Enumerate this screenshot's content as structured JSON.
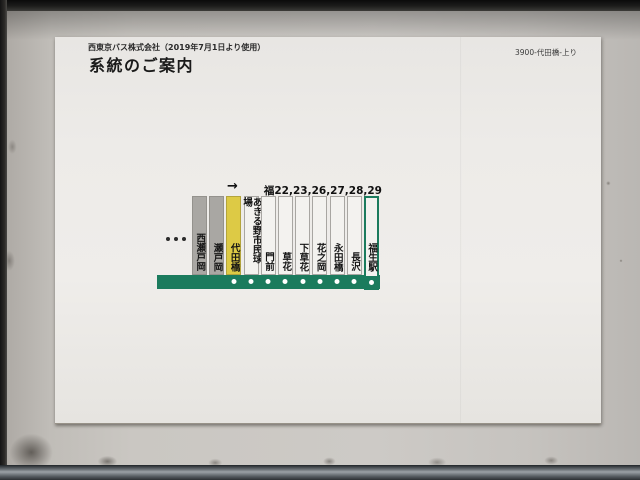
{
  "sign": {
    "company_line": "西東京バス株式会社（2019年7月1日より使用）",
    "title": "系統のご案内",
    "sign_code": "3900-代田橋-上り"
  },
  "diagram": {
    "routes_label": "福22,23,26,27,28,29",
    "direction_arrow": "→",
    "continuation_dots": "...",
    "stops": [
      {
        "name": "西瀬戸岡",
        "type": "passed"
      },
      {
        "name": "瀬戸岡",
        "type": "passed"
      },
      {
        "name": "代田橋",
        "type": "current"
      },
      {
        "name": "あきる野市民球場",
        "type": "upcoming"
      },
      {
        "name": "門前",
        "type": "upcoming"
      },
      {
        "name": "草花",
        "type": "upcoming"
      },
      {
        "name": "下草花",
        "type": "upcoming"
      },
      {
        "name": "花之岡",
        "type": "upcoming"
      },
      {
        "name": "永田橋",
        "type": "upcoming"
      },
      {
        "name": "長沢",
        "type": "upcoming"
      },
      {
        "name": "福生駅",
        "type": "terminal"
      }
    ],
    "colors": {
      "line_green": "#1b7b5d",
      "current_stop_yellow": "#ddca45",
      "passed_stop_gray": "#a9a7a3"
    }
  }
}
